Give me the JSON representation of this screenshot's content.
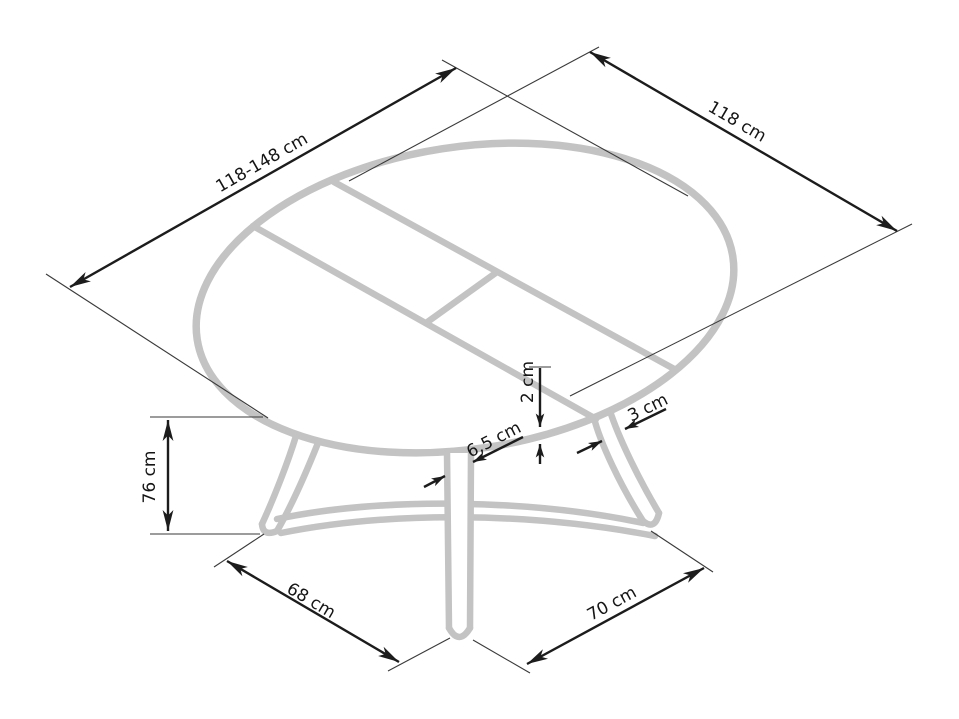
{
  "diagram": {
    "kind": "furniture-dimension-drawing",
    "subject": "round extendable pedestal dining table",
    "units": "cm",
    "background_color": "#ffffff",
    "colors": {
      "table_outline": "#c3c3c3",
      "dimension_lines": "#1c1c1c",
      "label_text": "#151515"
    },
    "dimensions": [
      {
        "id": "table-length-extendable",
        "label": "118-148 cm"
      },
      {
        "id": "table-width",
        "label": "118 cm"
      },
      {
        "id": "table-height",
        "label": "76 cm"
      },
      {
        "id": "base-span-left",
        "label": "68 cm"
      },
      {
        "id": "base-span-right",
        "label": "70 cm"
      },
      {
        "id": "tabletop-thickness",
        "label": "2 cm"
      },
      {
        "id": "center-leg-width",
        "label": "6,5 cm"
      },
      {
        "id": "leg-strut-width",
        "label": "3 cm"
      }
    ]
  }
}
